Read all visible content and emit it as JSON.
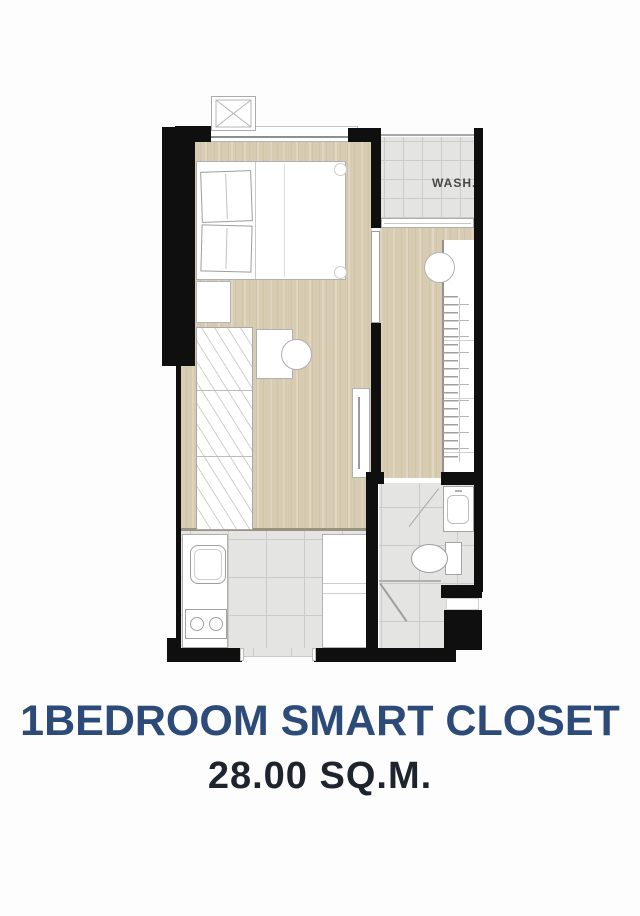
{
  "title": {
    "line1": "1BEDROOM SMART CLOSET",
    "line2": "28.00 SQ.M."
  },
  "labels": {
    "wash": "WASH."
  },
  "colors": {
    "title_navy": "#2d4b78",
    "area_dark": "#1e242d",
    "wall": "#0f0f0f",
    "wood": "#d7cbb1",
    "tile": "#e4e4e3",
    "tile_line": "#cbcbc9",
    "outline": "#b3b3b3",
    "label_gray": "#474747"
  }
}
